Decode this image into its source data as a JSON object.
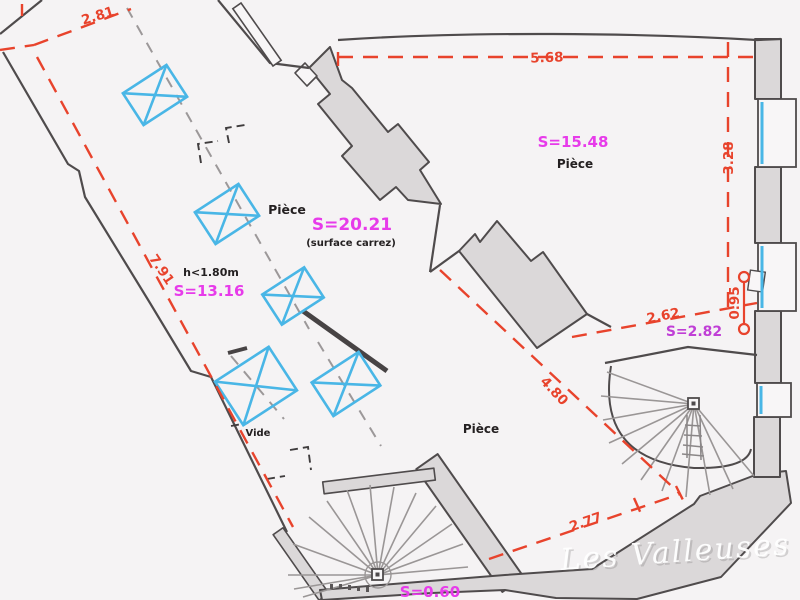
{
  "document": {
    "type": "architectural-floor-plan",
    "watermark": {
      "text": "Les Valleuses"
    }
  },
  "labels": {
    "room_attic": {
      "name": "Pièce",
      "surface": "S=20.21",
      "note": "(surface carrez)"
    },
    "room_attic_low": {
      "name": "h<1.80m",
      "surface": "S=13.16"
    },
    "room_top_right": {
      "surface": "S=15.48",
      "name": "Pièce"
    },
    "room_bottom": {
      "name": "Pièce"
    },
    "void_area": {
      "name": "Vide"
    },
    "closet": {
      "surface": "S=2.82"
    },
    "stair_area": {
      "surface": "S=0.60"
    }
  },
  "dimensions": {
    "top_left": "2.81",
    "left": "7.91",
    "top_right": "5.68",
    "right": "3.28",
    "middle_right": "2.62",
    "right_small": "0.95",
    "diagonal": "4.80",
    "bottom": "2.77"
  },
  "colors": {
    "dimension_red": "#e8432c",
    "surface_magenta": "#e73bea",
    "surface_purple": "#c03fd6",
    "window_blue": "#49b6e6",
    "wall_fill": "#dbd8d9",
    "wall_stroke": "#4f4b4c",
    "background": "#f5f3f4"
  }
}
